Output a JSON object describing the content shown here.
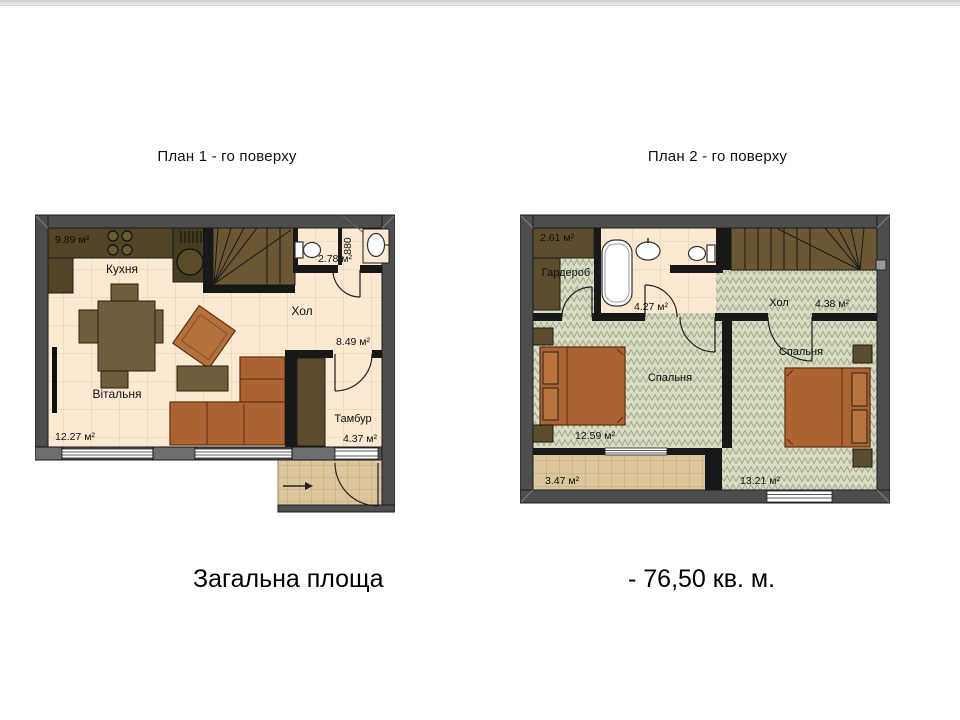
{
  "page": {
    "plan1_title": "План 1 - го поверху",
    "plan2_title": "План 2 - го поверху",
    "footer_label": "Загальна площа",
    "footer_value": "- 76,50 кв. м."
  },
  "plan1": {
    "kitchen_name": "Кухня",
    "kitchen_area": "9.89 м²",
    "wc_area": "2.78 м²",
    "niche_width": "880",
    "hall_name": "Хол",
    "hall_area": "8.49 м²",
    "living_name": "Вітальня",
    "living_area": "12.27 м²",
    "tambur_name": "Тамбур",
    "tambur_area": "4.37 м²"
  },
  "plan2": {
    "wardrobe_area": "2.61 м²",
    "wardrobe_name": "Гардероб",
    "bath_area": "4.27 м²",
    "hall_name": "Хол",
    "hall_area": "4.38 м²",
    "bedroom1_name": "Спальня",
    "bedroom1_area": "12.59 м²",
    "bedroom2_name": "Спальня",
    "bedroom2_area": "13.21 м²",
    "balcony_area": "3.47 м²"
  },
  "colors": {
    "wall": "#4d4d4d",
    "partition": "#181818",
    "floor_cream": "#fbe9d2",
    "floor_herringbone": "#d9dbc3",
    "floor_tan_tile": "#dcc69c",
    "stairs": "#6b5733",
    "wood_furniture": "#6f5e3b",
    "upholstery": "#ad6231"
  }
}
